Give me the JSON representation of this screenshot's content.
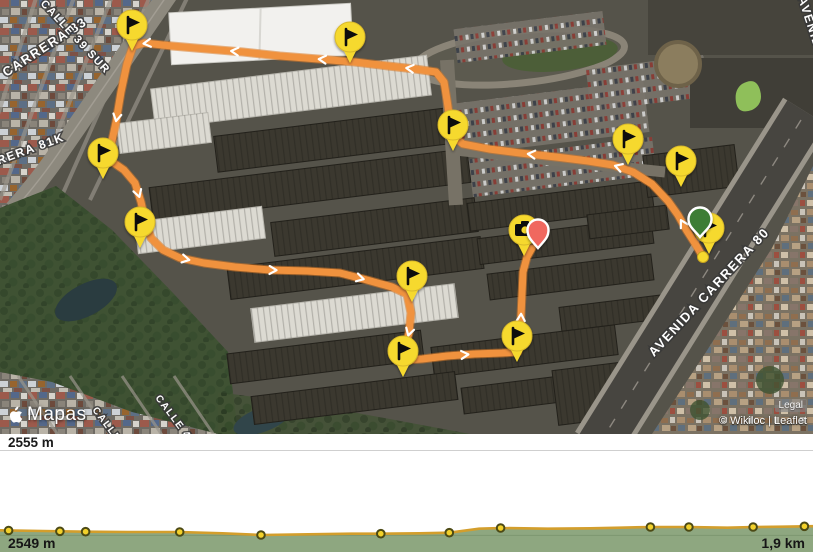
{
  "map": {
    "street_labels": [
      {
        "text": "CARRERA 83",
        "x": 88,
        "y": 24,
        "rotate": -33,
        "size": 13,
        "anchor": "end"
      },
      {
        "text": "CALLE 39 SUR",
        "x": 40,
        "y": 4,
        "rotate": 47,
        "size": 11,
        "anchor": "start"
      },
      {
        "text": "CARRERA 81K",
        "x": -30,
        "y": 175,
        "rotate": -20,
        "size": 12,
        "anchor": "start"
      },
      {
        "text": "CALLE",
        "x": 92,
        "y": 410,
        "rotate": 53,
        "size": 10,
        "anchor": "start"
      },
      {
        "text": "CALLE 4",
        "x": 155,
        "y": 398,
        "rotate": 53,
        "size": 10,
        "anchor": "start"
      },
      {
        "text": "AVENIDA CARRERA 80",
        "x": 712,
        "y": 295,
        "rotate": -47,
        "size": 13,
        "anchor": "middle"
      },
      {
        "text": "AVENIDA",
        "x": 798,
        "y": -2,
        "rotate": 72,
        "size": 12,
        "anchor": "start"
      }
    ],
    "route": {
      "color": "#f0923e",
      "casing": "#d87a28",
      "points": [
        [
          703,
          257
        ],
        [
          696,
          245
        ],
        [
          687,
          231
        ],
        [
          678,
          215
        ],
        [
          668,
          201
        ],
        [
          652,
          184
        ],
        [
          633,
          172
        ],
        [
          613,
          165
        ],
        [
          588,
          161
        ],
        [
          556,
          157
        ],
        [
          520,
          153
        ],
        [
          489,
          149
        ],
        [
          463,
          144
        ],
        [
          453,
          136
        ],
        [
          450,
          120
        ],
        [
          447,
          100
        ],
        [
          444,
          82
        ],
        [
          436,
          72
        ],
        [
          415,
          69
        ],
        [
          388,
          66
        ],
        [
          355,
          62
        ],
        [
          318,
          59
        ],
        [
          280,
          56
        ],
        [
          243,
          52
        ],
        [
          207,
          49
        ],
        [
          172,
          46
        ],
        [
          144,
          43
        ],
        [
          133,
          46
        ],
        [
          127,
          64
        ],
        [
          121,
          92
        ],
        [
          116,
          122
        ],
        [
          110,
          150
        ],
        [
          111,
          161
        ],
        [
          124,
          170
        ],
        [
          135,
          183
        ],
        [
          141,
          202
        ],
        [
          145,
          220
        ],
        [
          151,
          238
        ],
        [
          163,
          250
        ],
        [
          180,
          258
        ],
        [
          204,
          263
        ],
        [
          235,
          267
        ],
        [
          270,
          270
        ],
        [
          307,
          271
        ],
        [
          340,
          273
        ],
        [
          367,
          280
        ],
        [
          392,
          287
        ],
        [
          407,
          294
        ],
        [
          411,
          313
        ],
        [
          409,
          333
        ],
        [
          404,
          350
        ],
        [
          406,
          360
        ],
        [
          422,
          359
        ],
        [
          447,
          356
        ],
        [
          474,
          354
        ],
        [
          502,
          353
        ],
        [
          518,
          352
        ],
        [
          520,
          337
        ],
        [
          521,
          316
        ],
        [
          522,
          294
        ],
        [
          523,
          272
        ],
        [
          527,
          257
        ],
        [
          532,
          248
        ]
      ]
    },
    "markers": {
      "flag_color": "#f6d92e",
      "flags": [
        [
          132,
          25
        ],
        [
          350,
          37
        ],
        [
          453,
          125
        ],
        [
          628,
          139
        ],
        [
          681,
          161
        ],
        [
          103,
          153
        ],
        [
          140,
          222
        ],
        [
          412,
          276
        ],
        [
          403,
          351
        ],
        [
          517,
          336
        ],
        [
          709,
          228
        ]
      ],
      "photo": {
        "x": 524,
        "y": 230
      },
      "start_pin": {
        "x": 700,
        "y": 219,
        "color": "#3c7d36"
      },
      "end_pin": {
        "x": 538,
        "y": 230,
        "color": "#f0685f"
      },
      "trail_dot": {
        "x": 703,
        "y": 257
      }
    },
    "attribution": {
      "apple_maps": "Mapas",
      "legal": "Legal",
      "credits": "© Wikiloc | Leaflet"
    }
  },
  "elevation_panel": {
    "max_elevation_label": "2555 m"
  },
  "chart_data": {
    "type": "area",
    "title": "Elevation profile",
    "xlabel": "distance (km)",
    "ylabel": "elevation (m)",
    "x_range_km": [
      0,
      1.9
    ],
    "ylim": [
      2549,
      2555
    ],
    "gridline_m": 2550,
    "x_km": [
      0,
      0.1,
      0.2,
      0.3,
      0.42,
      0.52,
      0.61,
      0.72,
      0.82,
      0.89,
      0.98,
      1.05,
      1.12,
      1.17,
      1.28,
      1.38,
      1.45,
      1.52,
      1.61,
      1.7,
      1.76,
      1.83,
      1.9
    ],
    "elev_m": [
      2550.3,
      2550.26,
      2550.22,
      2550.2,
      2550.2,
      2550.12,
      2550.02,
      2550.06,
      2550.1,
      2550.1,
      2550.12,
      2550.16,
      2550.4,
      2550.44,
      2550.4,
      2550.42,
      2550.46,
      2550.5,
      2550.5,
      2550.46,
      2550.5,
      2550.52,
      2550.55
    ],
    "waypoint_dots_km": [
      0.02,
      0.14,
      0.2,
      0.42,
      0.61,
      0.89,
      1.05,
      1.17,
      1.52,
      1.61,
      1.76,
      1.88
    ],
    "min_label": "2549 m",
    "distance_label": "1,9 km",
    "colors": {
      "fill": "#8ea780",
      "line": "#d39e2c",
      "dot": "#f2d12b",
      "dot_ring": "#4c4a15",
      "grid": "#7d9770"
    }
  }
}
